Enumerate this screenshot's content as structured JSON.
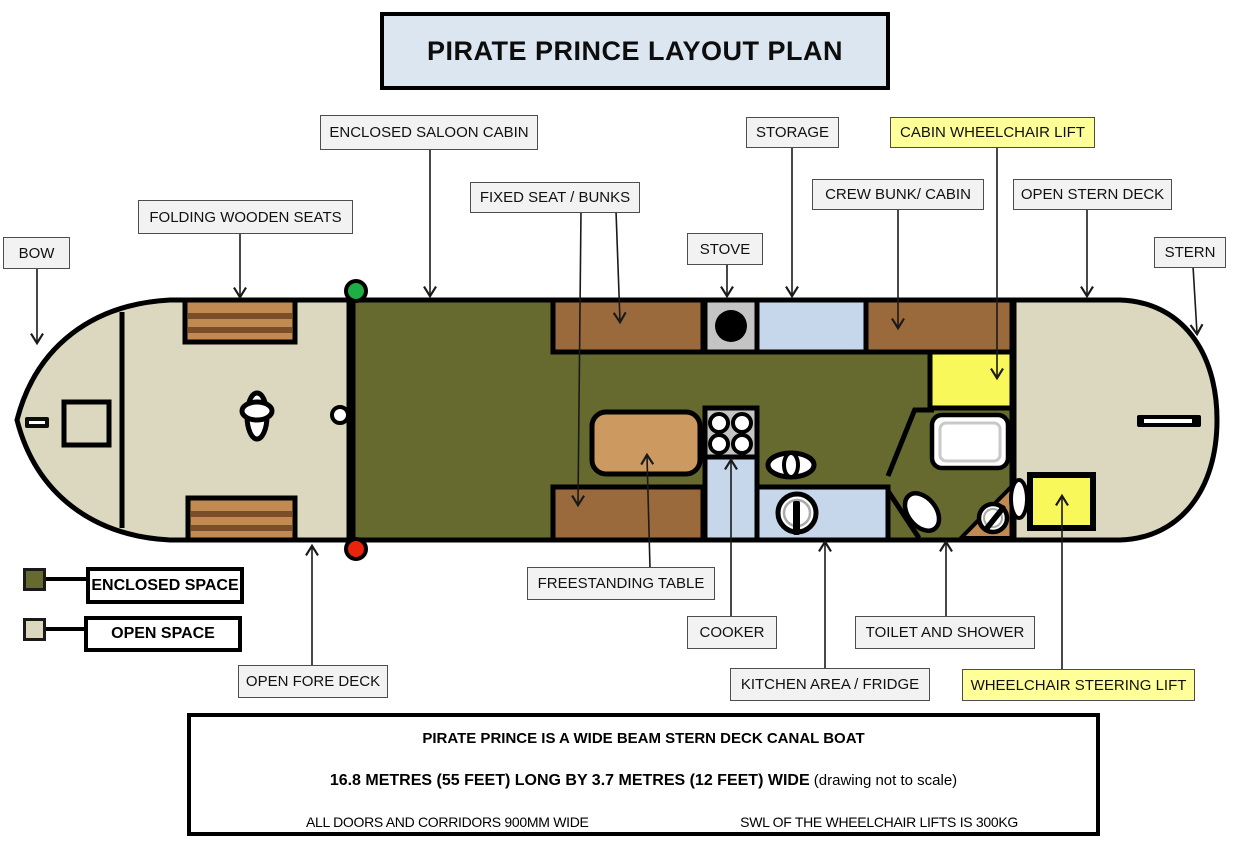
{
  "title": "PIRATE PRINCE LAYOUT PLAN",
  "callouts": {
    "bow": "BOW",
    "folding_wooden_seats": "FOLDING WOODEN SEATS",
    "enclosed_saloon_cabin": "ENCLOSED SALOON CABIN",
    "fixed_seat_bunks": "FIXED SEAT / BUNKS",
    "stove": "STOVE",
    "storage": "STORAGE",
    "crew_bunk_cabin": "CREW BUNK/ CABIN",
    "cabin_wheelchair_lift": "CABIN WHEELCHAIR LIFT",
    "open_stern_deck": "OPEN STERN DECK",
    "stern": "STERN",
    "open_fore_deck": "OPEN FORE DECK",
    "freestanding_table": "FREESTANDING TABLE",
    "cooker": "COOKER",
    "kitchen_area_fridge": "KITCHEN AREA / FRIDGE",
    "toilet_and_shower": "TOILET AND SHOWER",
    "wheelchair_steering_lift": "WHEELCHAIR STEERING LIFT"
  },
  "legend": {
    "enclosed_space": "ENCLOSED SPACE",
    "open_space": "OPEN SPACE"
  },
  "info_box": {
    "line1": "PIRATE PRINCE IS A WIDE BEAM STERN DECK CANAL BOAT",
    "line2_bold": "16.8 METRES (55 FEET) LONG BY 3.7 METRES (12 FEET) WIDE",
    "line2_normal": " (drawing not to scale)",
    "line3_left": "ALL DOORS AND CORRIDORS 900MM WIDE",
    "line3_right": "SWL OF THE WHEELCHAIR LIFTS IS 300KG"
  },
  "colors": {
    "enclosed_space": "#666A2F",
    "open_space": "#DCD8C0",
    "highlight_label": "#FFFF99",
    "title_bg": "#DCE6F1",
    "lift_yellow": "#F8F85A",
    "wood_dark": "#9A6A3C",
    "wood_seat": "#C18A52",
    "wood_table": "#CC9A60",
    "interior_blue": "#C6D7EB",
    "appliance_grey": "#C4C4C4",
    "nav_light_green": "#1FAE44",
    "nav_light_red": "#E8240C"
  }
}
